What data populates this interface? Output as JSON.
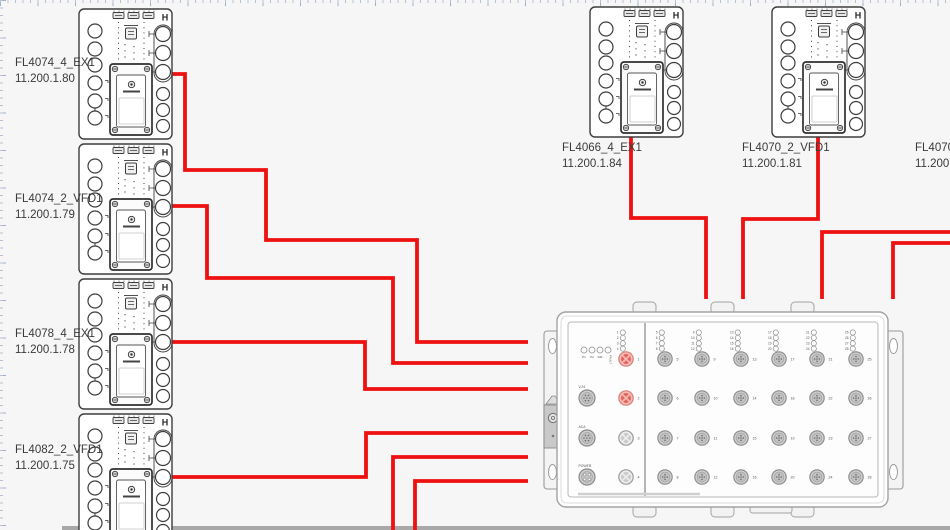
{
  "app": {
    "background": "#f6f6f7",
    "ruler_tick_color": "#b7c1d4",
    "cable_color": "#ee1111",
    "page_strip_color": "#a8a8a8"
  },
  "devices": {
    "corner_mark": "H",
    "left": [
      {
        "name": "FL4074_4_EX1",
        "ip": "11.200.1.80"
      },
      {
        "name": "FL4074_2_VFD1",
        "ip": "11.200.1.79"
      },
      {
        "name": "FL4078_4_EX1",
        "ip": "11.200.1.78"
      },
      {
        "name": "FL4082_2_VFD1",
        "ip": "11.200.1.75"
      }
    ],
    "top": [
      {
        "name": "FL4066_4_EX1",
        "ip": "11.200.1.84"
      },
      {
        "name": "FL4070_2_VFD1",
        "ip": "11.200.1.81"
      }
    ],
    "right_clipped": {
      "name": "FL4070_4",
      "ip": "11.200.1."
    }
  },
  "switch": {
    "status_leds": [
      "P1",
      "P2",
      "RM",
      "FAULT"
    ],
    "aux_ports": [
      "V.24",
      "ACA",
      "POWER"
    ],
    "ports": [
      1,
      2,
      3,
      4,
      5,
      6,
      7,
      8,
      9,
      10,
      11,
      12,
      13,
      14,
      15,
      16,
      17,
      18,
      19,
      20,
      21,
      22,
      23,
      24,
      25,
      26,
      27,
      28
    ],
    "highlighted_ports": [
      1,
      2
    ]
  },
  "connections": [
    {
      "from": "FL4074_4_EX1",
      "points": [
        [
          171,
          74
        ],
        [
          185,
          74
        ],
        [
          185,
          170
        ],
        [
          266,
          170
        ],
        [
          266,
          240
        ],
        [
          417,
          240
        ],
        [
          417,
          342
        ],
        [
          528,
          342
        ]
      ]
    },
    {
      "from": "FL4074_2_VFD1",
      "points": [
        [
          171,
          206
        ],
        [
          207,
          206
        ],
        [
          207,
          278
        ],
        [
          393,
          278
        ],
        [
          393,
          363
        ],
        [
          528,
          363
        ]
      ]
    },
    {
      "from": "FL4078_4_EX1",
      "points": [
        [
          171,
          342
        ],
        [
          365,
          342
        ],
        [
          365,
          389
        ],
        [
          528,
          389
        ]
      ]
    },
    {
      "from": "FL4082_2_VFD1",
      "points": [
        [
          171,
          477
        ],
        [
          366,
          477
        ],
        [
          366,
          433
        ],
        [
          528,
          433
        ]
      ]
    },
    {
      "from": "offscreen-bottom-a",
      "points": [
        [
          393,
          531
        ],
        [
          393,
          457
        ],
        [
          528,
          457
        ]
      ]
    },
    {
      "from": "offscreen-bottom-b",
      "points": [
        [
          415,
          531
        ],
        [
          415,
          481
        ],
        [
          528,
          481
        ]
      ]
    },
    {
      "from": "FL4066_4_EX1",
      "points": [
        [
          631,
          133
        ],
        [
          631,
          218
        ],
        [
          706,
          218
        ],
        [
          706,
          299
        ]
      ]
    },
    {
      "from": "FL4070_2_VFD1",
      "points": [
        [
          818,
          133
        ],
        [
          818,
          219
        ],
        [
          743,
          219
        ],
        [
          743,
          299
        ]
      ]
    },
    {
      "from": "offscreen-right-a",
      "points": [
        [
          951,
          232
        ],
        [
          822,
          232
        ],
        [
          822,
          299
        ]
      ]
    },
    {
      "from": "offscreen-right-b",
      "points": [
        [
          951,
          243
        ],
        [
          893,
          243
        ],
        [
          893,
          299
        ]
      ]
    }
  ]
}
